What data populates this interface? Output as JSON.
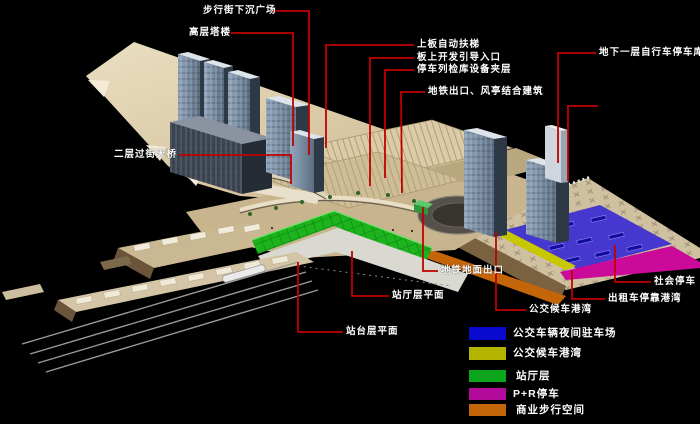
{
  "scene": {
    "description": "轨道交通枢纽站区轴测分析图",
    "background": "#000000",
    "leader_line_color": "#c00000",
    "label_text_color": "#ffffff"
  },
  "callouts": [
    {
      "id": "pedestrian-sunken-plaza",
      "label": "步行街下沉广场"
    },
    {
      "id": "highrise-tower",
      "label": "高层塔楼"
    },
    {
      "id": "deck-escalator",
      "label": "上板自动扶梯"
    },
    {
      "id": "deck-development-entrance",
      "label": "板上开发引导入口"
    },
    {
      "id": "train-inspection-mezzanine",
      "label": "停车列检库设备夹层"
    },
    {
      "id": "b1-bicycle-parking",
      "label": "地下一层自行车停车库"
    },
    {
      "id": "metro-exit-vent-building",
      "label": "地铁出口、风亭结合建筑"
    },
    {
      "id": "l2-footbridge",
      "label": "二层过街天桥"
    },
    {
      "id": "metro-ground-exit",
      "label": "地铁地面出口"
    },
    {
      "id": "concourse-level-plan",
      "label": "站厅层平面"
    },
    {
      "id": "platform-level-plan",
      "label": "站台层平面"
    },
    {
      "id": "bus-waiting-bay",
      "label": "公交候车港湾"
    },
    {
      "id": "taxi-bay",
      "label": "出租车停靠港湾"
    },
    {
      "id": "public-parking",
      "label": "社会停车"
    }
  ],
  "legend": {
    "items": [
      {
        "label": "公交车辆夜间驻车场",
        "color": "#0909cf"
      },
      {
        "label": "公交候车港湾",
        "color": "#b4b400"
      },
      {
        "label": "站厅层",
        "color": "#0ca61c"
      },
      {
        "label": "P+R停车",
        "color": "#b30a9b"
      },
      {
        "label": "商业步行空间",
        "color": "#c4650a"
      }
    ]
  }
}
